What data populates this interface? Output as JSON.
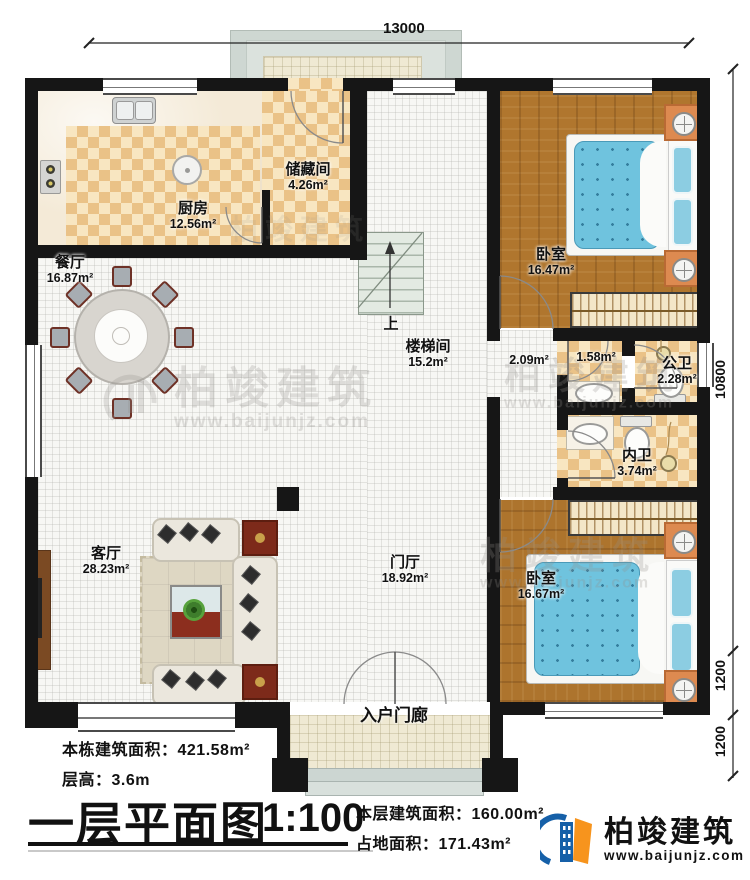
{
  "dimensions": {
    "top_width": "13000",
    "right_total": "10800",
    "right_seg1": "1200",
    "right_seg2": "1200"
  },
  "rooms": [
    {
      "id": "kitchen",
      "name": "厨房",
      "area": "12.56m²"
    },
    {
      "id": "storage",
      "name": "储藏间",
      "area": "4.26m²"
    },
    {
      "id": "dining",
      "name": "餐厅",
      "area": "16.87m²"
    },
    {
      "id": "bedroom-top",
      "name": "卧室",
      "area": "16.47m²"
    },
    {
      "id": "stairwell",
      "name": "楼梯间",
      "area": "15.2m²"
    },
    {
      "id": "corridor",
      "name": "",
      "area": "2.09m²"
    },
    {
      "id": "vestibule",
      "name": "",
      "area": "1.58m²"
    },
    {
      "id": "public-bath",
      "name": "公卫",
      "area": "2.28m²"
    },
    {
      "id": "private-bath",
      "name": "内卫",
      "area": "3.74m²"
    },
    {
      "id": "living",
      "name": "客厅",
      "area": "28.23m²"
    },
    {
      "id": "foyer",
      "name": "门厅",
      "area": "18.92m²"
    },
    {
      "id": "bedroom-bottom",
      "name": "卧室",
      "area": "16.67m²"
    },
    {
      "id": "entry-porch",
      "name": "入户门廊",
      "area": ""
    }
  ],
  "stairs_up": "上",
  "info": {
    "building_total_area": "本栋建筑面积：421.58m²",
    "floor_height": "层高：3.6m",
    "plan_title": "一层平面图",
    "scale": "1:100",
    "floor_area": "本层建筑面积：160.00m²",
    "footprint_area": "占地面积：171.43m²"
  },
  "brand": {
    "name": "柏竣建筑",
    "website": "www.baijunjz.com"
  },
  "watermark": {
    "name": "柏竣建筑",
    "website": "www.baijunjz.com"
  },
  "colors": {
    "wall": "#161616",
    "checker_tile": "#eac287",
    "wood_floor": "#b0762e",
    "bed_blue": "#6fc3de",
    "nightstand_orange": "#dd8a50",
    "logo_blue": "#1660a8",
    "logo_orange": "#f7941d"
  }
}
